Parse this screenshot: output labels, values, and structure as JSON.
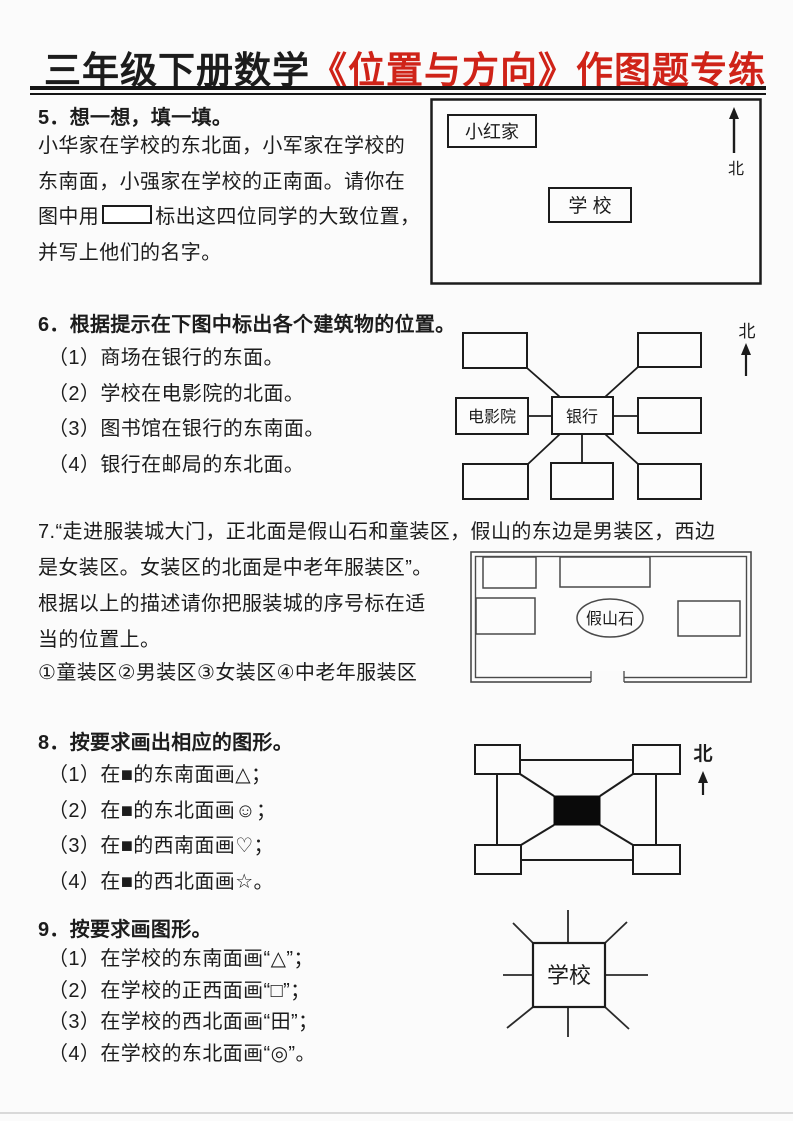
{
  "page": {
    "background": "#fbfbfb",
    "ink_color": "#1c1c1c",
    "accent_red": "#cf2318"
  },
  "title": {
    "black_part": "三年级下册数学",
    "red_part": "《位置与方向》作图题专练"
  },
  "q5": {
    "heading": "5．想一想，填一填。",
    "line1": "小华家在学校的东北面，小军家在学校的",
    "line2": "东南面，小强家在学校的正南面。请你在",
    "line3_before_box": "图中用",
    "line3_after_box": "标出这四位同学的大致位置，",
    "line4": "并写上他们的名字。",
    "diagram": {
      "home_label": "小红家",
      "school_label": "学 校",
      "north_label": "北"
    }
  },
  "q6": {
    "heading": "6．根据提示在下图中标出各个建筑物的位置。",
    "items": [
      "（1）商场在银行的东面。",
      "（2）学校在电影院的北面。",
      "（3）图书馆在银行的东南面。",
      "（4）银行在邮局的东北面。"
    ],
    "diagram": {
      "cinema_label": "电影院",
      "bank_label": "银行",
      "north_label": "北"
    }
  },
  "q7": {
    "line1": "7.“走进服装城大门，正北面是假山石和童装区，假山的东边是男装区，西边",
    "line2": "是女装区。女装区的北面是中老年服装区”。",
    "line3": "根据以上的描述请你把服装城的序号标在适",
    "line4": "当的位置上。",
    "line5": "①童装区②男装区③女装区④中老年服装区",
    "diagram": {
      "rockery_label": "假山石"
    }
  },
  "q8": {
    "heading": "8．按要求画出相应的图形。",
    "items": [
      "（1）在■的东南面画△；",
      "（2）在■的东北面画☺；",
      "（3）在■的西南面画♡；",
      "（4）在■的西北面画☆。"
    ],
    "diagram": {
      "north_label": "北"
    }
  },
  "q9": {
    "heading": "9．按要求画图形。",
    "items": [
      "（1）在学校的东南面画“△”；",
      "（2）在学校的正西面画“□”；",
      "（3）在学校的西北面画“田”；",
      "（4）在学校的东北面画“◎”。"
    ],
    "diagram": {
      "school_label": "学校"
    }
  }
}
